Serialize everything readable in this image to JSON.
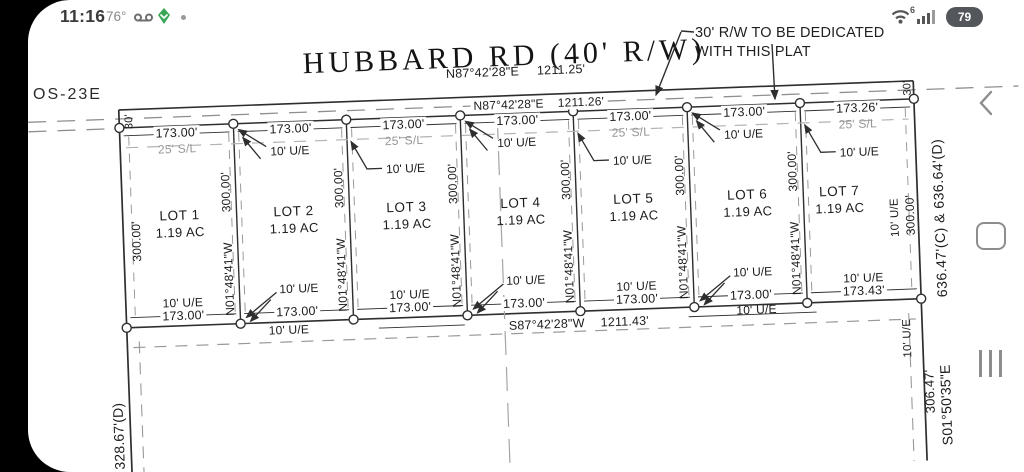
{
  "status_bar": {
    "time": "11:16",
    "temp": "76°",
    "battery": "79",
    "wifi_label": "6"
  },
  "plat": {
    "os_label": "OS-23E",
    "road_name": "HUBBARD RD (40' R/W)",
    "road_bearing": "N87°42'28\"E",
    "road_dist": "1211.25'",
    "north_bearing": "N87°42'28\"E",
    "north_dist": "1211.26'",
    "south_bearing": "S87°42'28\"W",
    "south_dist": "1211.43'",
    "note_line1": "30' R/W TO BE DEDICATED",
    "note_line2": "WITH THIS PLAT",
    "rw_half_width": "30'",
    "setback_label": "25' S/L",
    "easement_label": "10' U/E",
    "side_length": "300.00'",
    "side_bearing": "N01°48'41\"W",
    "west_boundary_dist": "328.67'(D)",
    "east_boundary_dist": "636.47'(C) & 636.64'(D)",
    "east_boundary_bearing": "S01°50'35\"E",
    "east_boundary_partial": "306.47'",
    "lots": [
      {
        "name": "LOT 1",
        "area": "1.19 AC",
        "front": "173.00'",
        "rear": "173.00'"
      },
      {
        "name": "LOT 2",
        "area": "1.19 AC",
        "front": "173.00'",
        "rear": "173.00'"
      },
      {
        "name": "LOT 3",
        "area": "1.19 AC",
        "front": "173.00'",
        "rear": "173.00'"
      },
      {
        "name": "LOT 4",
        "area": "1.19 AC",
        "front": "173.00'",
        "rear": "173.00'"
      },
      {
        "name": "LOT 5",
        "area": "1.19 AC",
        "front": "173.00'",
        "rear": "173.00'"
      },
      {
        "name": "LOT 6",
        "area": "1.19 AC",
        "front": "173.00'",
        "rear": "173.00'"
      },
      {
        "name": "LOT 7",
        "area": "1.19 AC",
        "front": "173.26'",
        "rear": "173.43'"
      }
    ]
  }
}
